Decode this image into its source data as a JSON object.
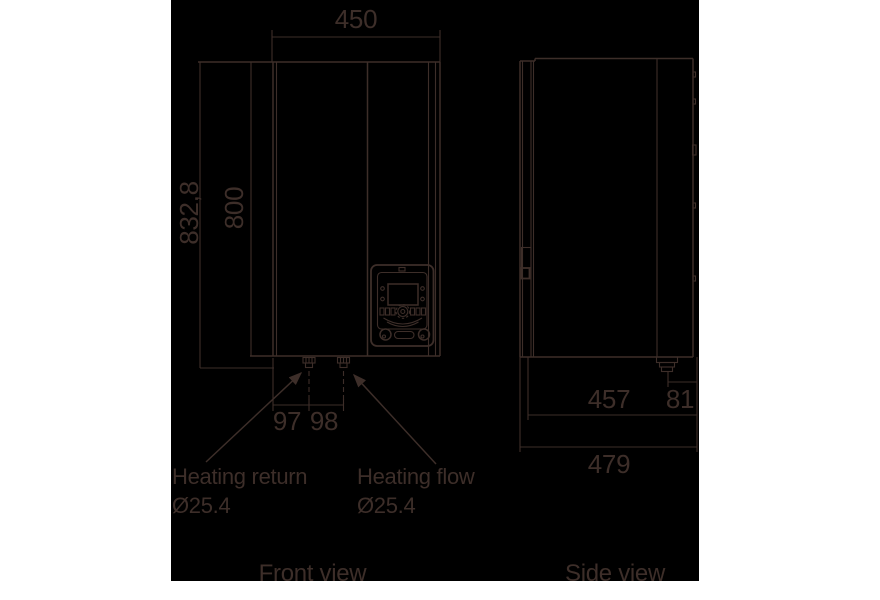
{
  "colors": {
    "page_background": "#ffffff",
    "canvas_background": "#000000",
    "ink": "#3d2e29"
  },
  "front_view": {
    "caption": "Front view",
    "dims": {
      "width": "450",
      "height_total": "832,8",
      "height_body": "800",
      "return_pipe_offset": "97",
      "pipe_spacing": "98"
    },
    "annotations": [
      {
        "label": "Heating return",
        "diameter": "Ø25.4"
      },
      {
        "label": "Heating flow",
        "diameter": "Ø25.4"
      }
    ]
  },
  "side_view": {
    "caption": "Side view",
    "dims": {
      "depth_to_pipe": "457",
      "pipe_to_wall": "81",
      "depth_total": "479"
    }
  }
}
